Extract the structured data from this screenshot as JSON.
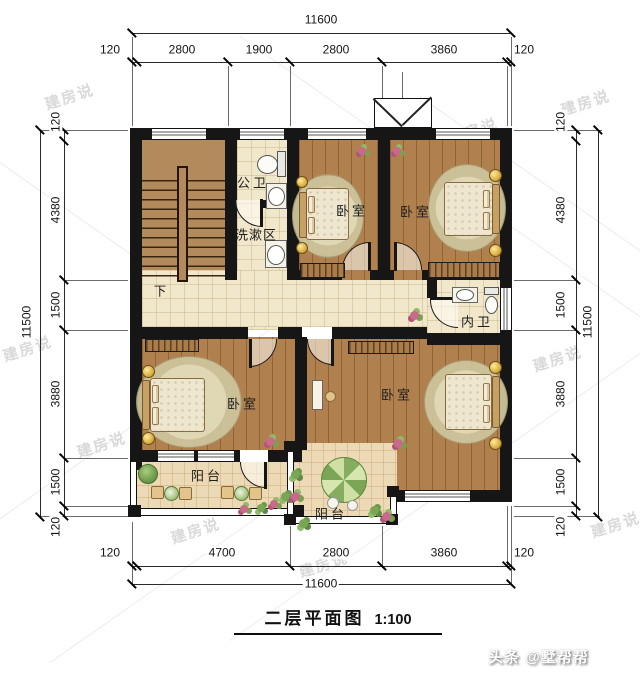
{
  "title": {
    "name": "二层平面图",
    "scale": "1:100"
  },
  "credit": "头条 @墅帮帮",
  "watermark": "建房说",
  "dimensions": {
    "top": {
      "total": "11600",
      "segments": [
        "120",
        "2800",
        "1900",
        "2800",
        "3860",
        "120"
      ]
    },
    "bottom": {
      "total": "11600",
      "segments": [
        "120",
        "4700",
        "2800",
        "3860",
        "120"
      ]
    },
    "left": {
      "total": "11500",
      "segments": [
        "120",
        "4380",
        "1500",
        "3880",
        "1500",
        "120"
      ]
    },
    "right": {
      "total": "11500",
      "segments": [
        "120",
        "4380",
        "1500",
        "3880",
        "1500",
        "120"
      ]
    }
  },
  "rooms": {
    "stairs_down": "下",
    "public_bath": "公卫",
    "wash_area": "洗漱区",
    "bedroom_top_left": "卧室",
    "bedroom_top_right": "卧室",
    "ensuite_bath": "内卫",
    "bedroom_bottom_left": "卧室",
    "bedroom_bottom_right": "卧室",
    "balcony_left": "阳台",
    "balcony_bottom": "阳台"
  },
  "colors": {
    "wall": "#161616",
    "wood_floor": "#b0804e",
    "tile_floor": "#f1e7cb",
    "balcony_floor": "#ecd9b5",
    "dimension_text": "#141414",
    "watermark": "#d9d9d9"
  }
}
